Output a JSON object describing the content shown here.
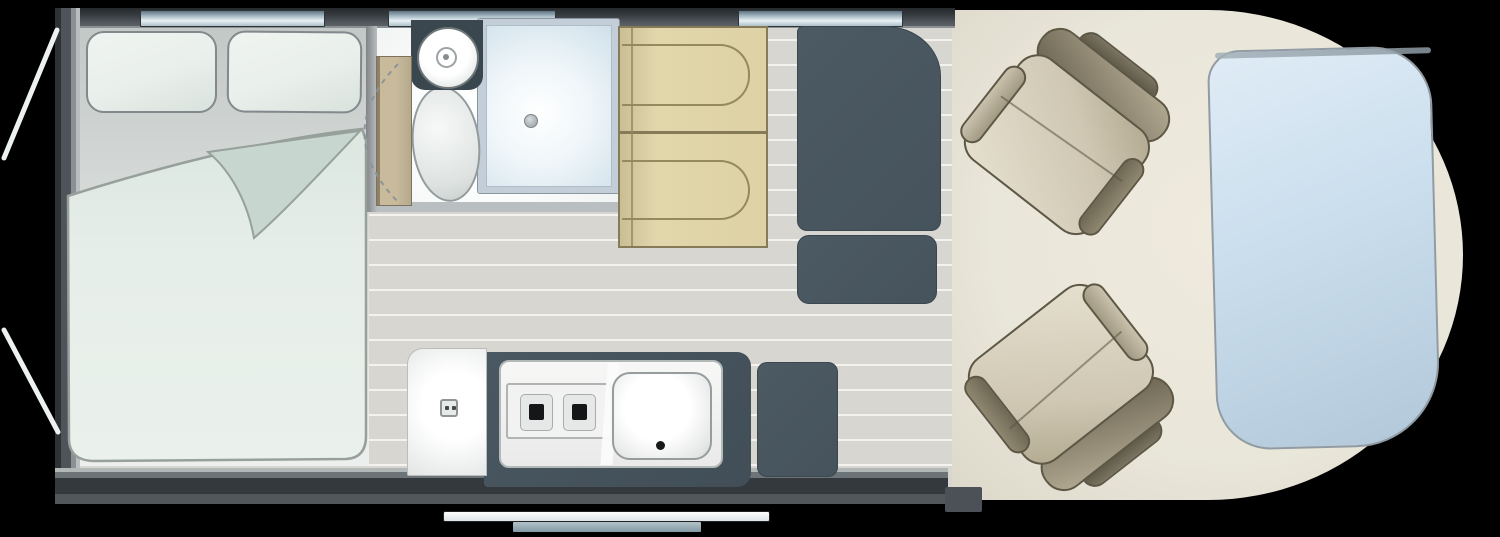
{
  "meta": {
    "diagram_type": "motorhome-floorplan-top-view",
    "canvas": {
      "width_px": 1500,
      "height_px": 537
    }
  },
  "fixtures": {
    "bedroom": {
      "name": "rear-double-bed",
      "pillow_count": 2,
      "has_folded_duvet": true
    },
    "washroom": {
      "name": "washroom",
      "items": [
        "washbasin",
        "toilet",
        "shower-tray",
        "sliding-tambour-door",
        "door-swing-arc"
      ]
    },
    "dinette": {
      "name": "forward-facing-travel-seats",
      "seat_count": 2
    },
    "storage": {
      "name": "wardrobe-unit",
      "sections": [
        "tall-wardrobe",
        "drawer-unit",
        "rear-low-unit"
      ]
    },
    "kitchen": {
      "name": "kitchen",
      "hob_burner_count": 2,
      "items": [
        "two-burner-hob",
        "sink-with-drainer",
        "worktop",
        "end-counter",
        "gas-control"
      ]
    },
    "cab": {
      "name": "cab",
      "swivel_seat_count": 2,
      "extras": [
        "drop-down-bed-panel"
      ]
    },
    "windows": {
      "count": 3,
      "positions": [
        "over-bed",
        "over-washroom",
        "over-wardrobe"
      ]
    },
    "entrance": {
      "name": "entry-step",
      "tread_count": 2
    },
    "corner_steadies": {
      "count": 2,
      "side": "rear-left"
    }
  },
  "palette": {
    "bg": "#000000",
    "wall-dark": "#34393d",
    "wall-mid": "#4e545a",
    "wall-edge": "#8a9093",
    "window-blue-dark": "#5f7280",
    "window-blue-mid": "#a9bcc6",
    "window-blue-light": "#e8f0f4",
    "floor-base": "#d8d6d1",
    "floor-stripe": "#f3f2ef",
    "bedroom-floor-dark": "#c3c8c6",
    "bedroom-floor-light": "#edefee",
    "mattress": "#e4ece7",
    "mattress-edge": "#97a09b",
    "mattress-fold": "#c7d6ce",
    "pillow": "#e9efeb",
    "pillow-edge": "#82898c",
    "door-tan": "#c9ba9c",
    "door-tan-dark": "#8e816a",
    "washroom-white": "#fdfefe",
    "slate": "#46535d",
    "slate-deep": "#3b474f",
    "shower-frame": "#c3ced8",
    "shower-tray": "#cfe0ea",
    "beige": "#ddd1a5",
    "beige-dark": "#857b58",
    "beige-line": "#95895f",
    "fixture-border": "#b3b8b8",
    "burner-dark": "#141617",
    "cab-floor": "#e9e6da",
    "cab-floor-dark": "#dcd8c9",
    "seat-light": "#e6e0cf",
    "seat-mid": "#b1a88f",
    "seat-dark": "#6b6451",
    "seat-deep": "#4a4536",
    "seat-outline": "#5d5745",
    "bed-blue-light": "#e0ecf6",
    "bed-blue-dark": "#b2c8d9",
    "bed-blue-edge": "#919ba3",
    "step-white": "#fdfefe",
    "step-gray": "#8299a4",
    "steady": "#eef1f1"
  }
}
